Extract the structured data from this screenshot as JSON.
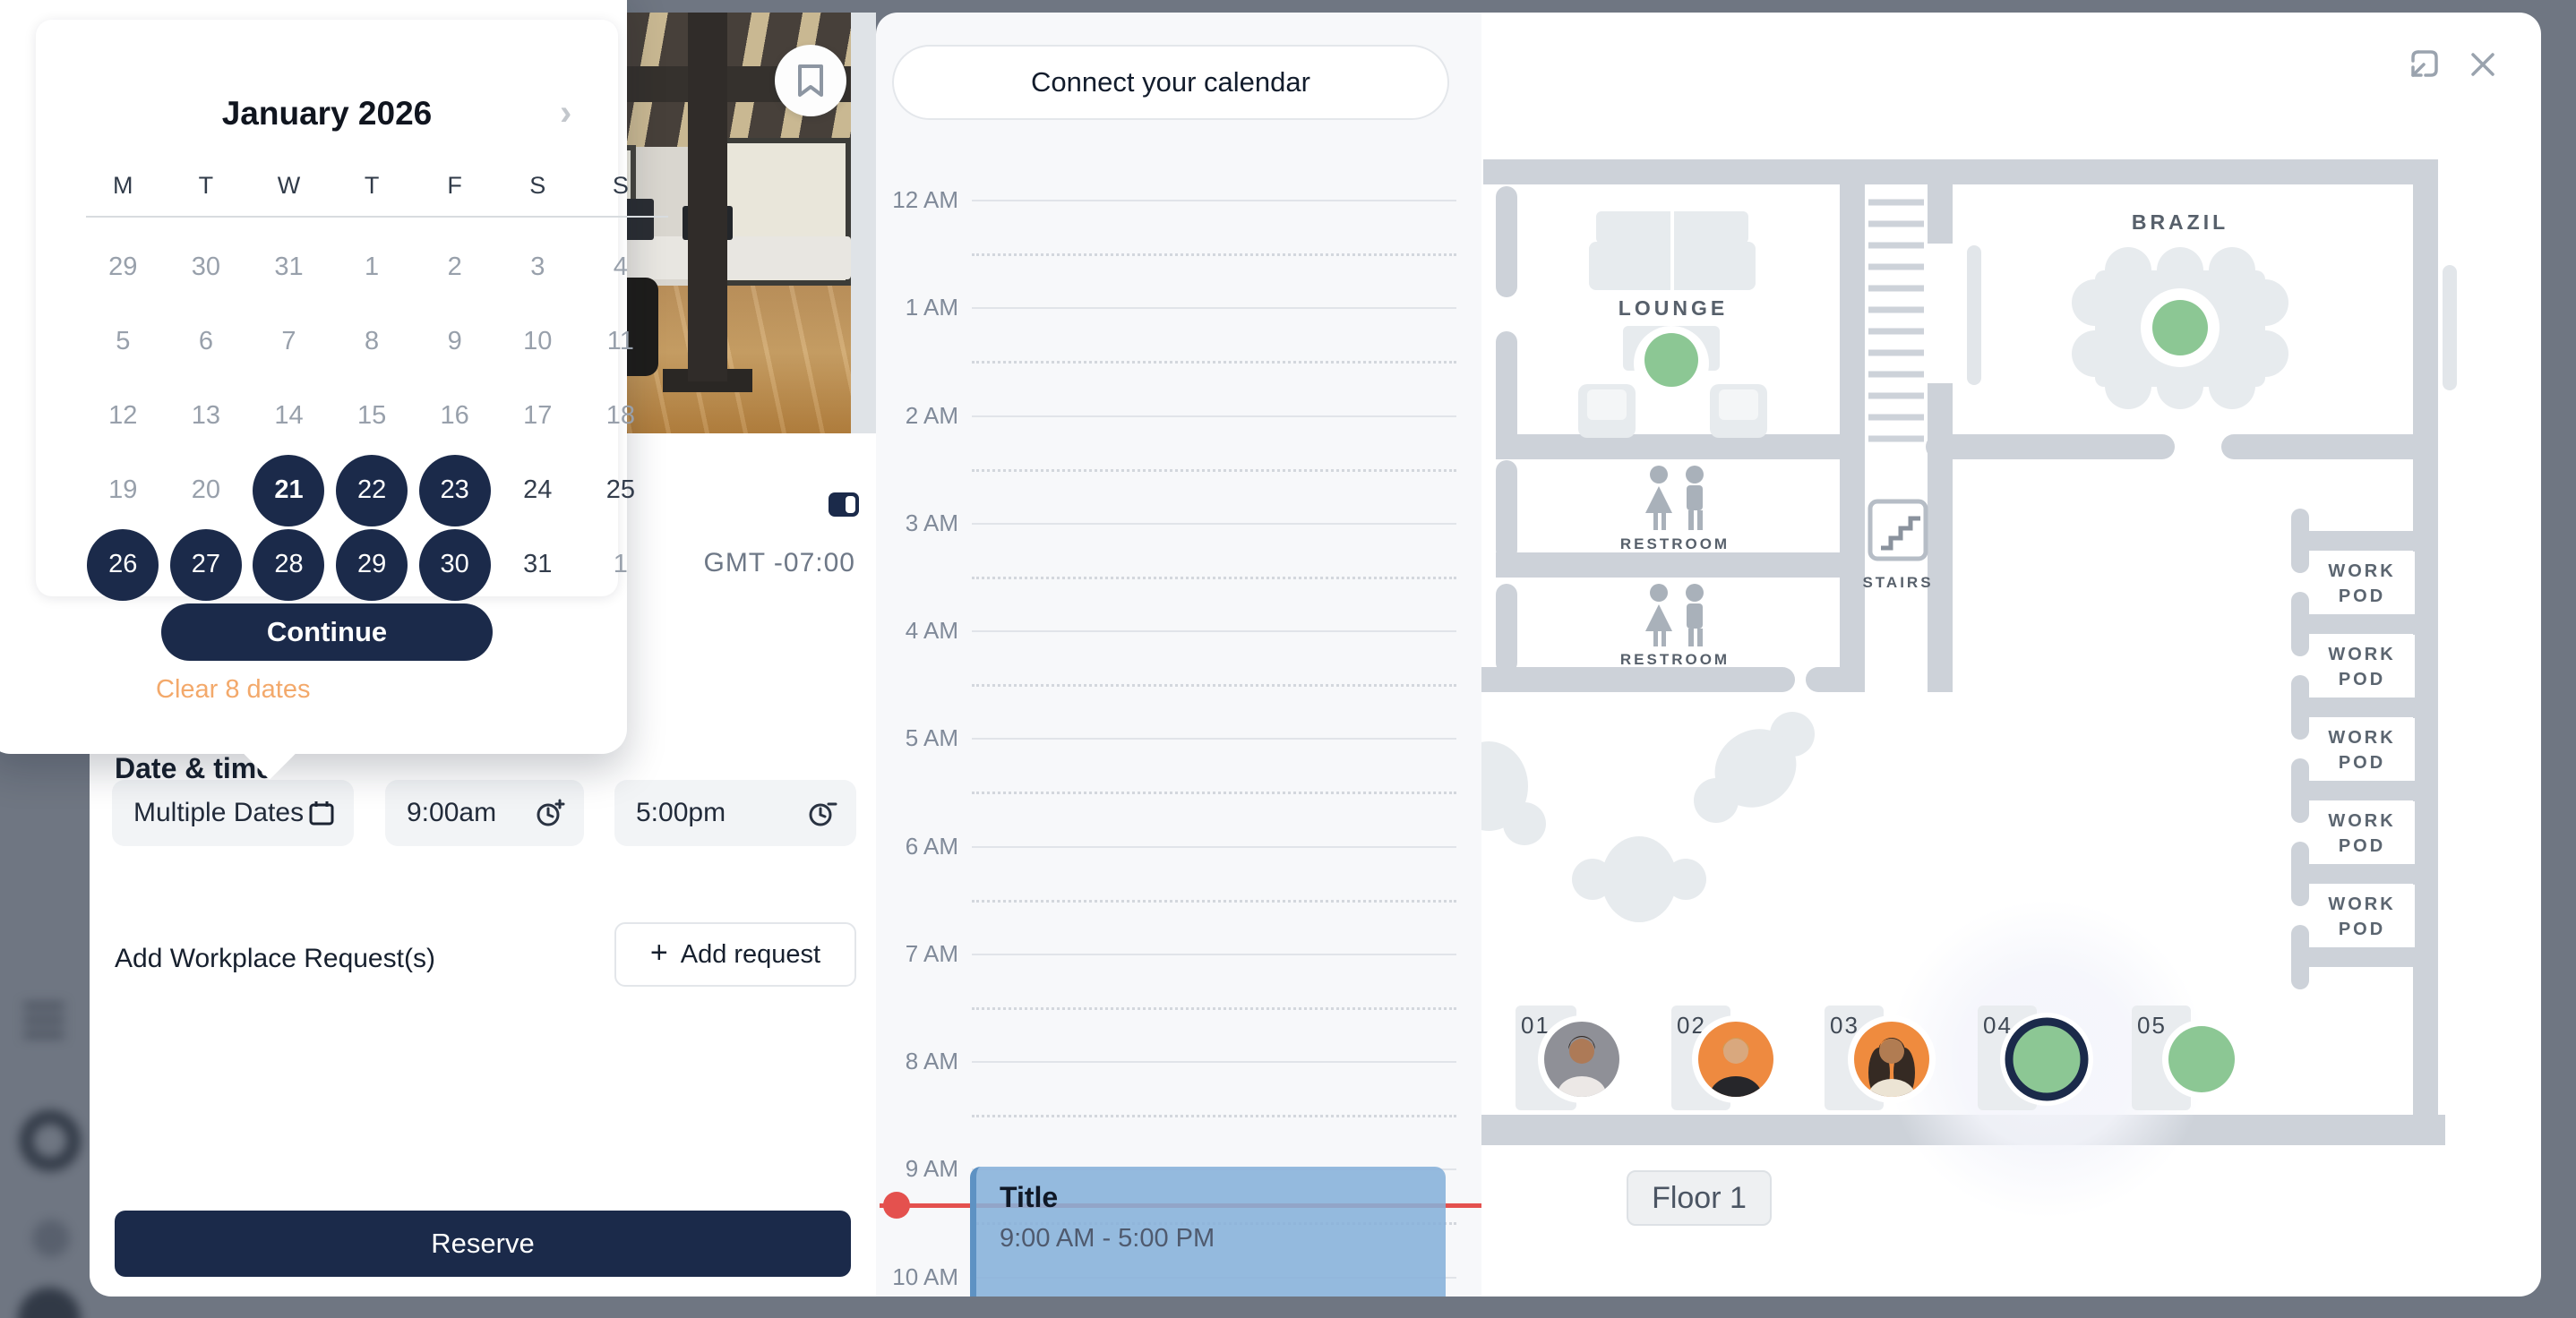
{
  "colors": {
    "accent_navy": "#1b2a4a",
    "available_green": "#8cc794",
    "clear_link_orange": "#f3a96b",
    "now_line_red": "#e4514e",
    "event_blue": "#86b0d9",
    "wall_gray": "#cdd2d9",
    "page_backdrop": "#6f7682"
  },
  "calendar_popover": {
    "title": "January 2026",
    "next_icon": "›",
    "weekdays": [
      "M",
      "T",
      "W",
      "T",
      "F",
      "S",
      "S"
    ],
    "days": [
      {
        "label": "29",
        "state": "past"
      },
      {
        "label": "30",
        "state": "past"
      },
      {
        "label": "31",
        "state": "past"
      },
      {
        "label": "1",
        "state": "past"
      },
      {
        "label": "2",
        "state": "past"
      },
      {
        "label": "3",
        "state": "past"
      },
      {
        "label": "4",
        "state": "past"
      },
      {
        "label": "5",
        "state": "past"
      },
      {
        "label": "6",
        "state": "past"
      },
      {
        "label": "7",
        "state": "past"
      },
      {
        "label": "8",
        "state": "past"
      },
      {
        "label": "9",
        "state": "past"
      },
      {
        "label": "10",
        "state": "past"
      },
      {
        "label": "11",
        "state": "past"
      },
      {
        "label": "12",
        "state": "past"
      },
      {
        "label": "13",
        "state": "past"
      },
      {
        "label": "14",
        "state": "past"
      },
      {
        "label": "15",
        "state": "past"
      },
      {
        "label": "16",
        "state": "past"
      },
      {
        "label": "17",
        "state": "past"
      },
      {
        "label": "18",
        "state": "past"
      },
      {
        "label": "19",
        "state": "past"
      },
      {
        "label": "20",
        "state": "past"
      },
      {
        "label": "21",
        "state": "selected-today"
      },
      {
        "label": "22",
        "state": "selected"
      },
      {
        "label": "23",
        "state": "selected"
      },
      {
        "label": "24",
        "state": "future"
      },
      {
        "label": "25",
        "state": "future"
      },
      {
        "label": "26",
        "state": "selected"
      },
      {
        "label": "27",
        "state": "selected"
      },
      {
        "label": "28",
        "state": "selected"
      },
      {
        "label": "29",
        "state": "selected"
      },
      {
        "label": "30",
        "state": "selected"
      },
      {
        "label": "31",
        "state": "future"
      },
      {
        "label": "1",
        "state": "past"
      }
    ],
    "selected_count": 8,
    "continue_label": "Continue",
    "clear_label": "Clear 8 dates"
  },
  "reserve_panel": {
    "timezone": "GMT -07:00",
    "date_time_label": "Date & time",
    "date_value": "Multiple Dates",
    "start_time_value": "9:00am",
    "end_time_value": "5:00pm",
    "requests_label": "Add Workplace Request(s)",
    "add_request_plus": "+",
    "add_request_label": "Add request",
    "reserve_label": "Reserve"
  },
  "schedule_panel": {
    "connect_button_label": "Connect your calendar",
    "hours": [
      "12 AM",
      "1 AM",
      "2 AM",
      "3 AM",
      "4 AM",
      "5 AM",
      "6 AM",
      "7 AM",
      "8 AM",
      "9 AM",
      "10 AM"
    ],
    "event": {
      "title": "Title",
      "time_range": "9:00 AM - 5:00 PM"
    }
  },
  "floorplan": {
    "rooms": {
      "lounge": "LOUNGE",
      "brazil": "BRAZIL",
      "restroom_upper": "RESTROOM",
      "restroom_lower": "RESTROOM",
      "stairs": "STAIRS"
    },
    "work_pods": [
      {
        "line1": "WORK",
        "line2": "POD"
      },
      {
        "line1": "WORK",
        "line2": "POD"
      },
      {
        "line1": "WORK",
        "line2": "POD"
      },
      {
        "line1": "WORK",
        "line2": "POD"
      },
      {
        "line1": "WORK",
        "line2": "POD"
      }
    ],
    "desks": [
      {
        "number": "01",
        "status": "occupied"
      },
      {
        "number": "02",
        "status": "occupied"
      },
      {
        "number": "03",
        "status": "occupied"
      },
      {
        "number": "04",
        "status": "selected"
      },
      {
        "number": "05",
        "status": "available"
      }
    ],
    "floor_label": "Floor 1"
  }
}
